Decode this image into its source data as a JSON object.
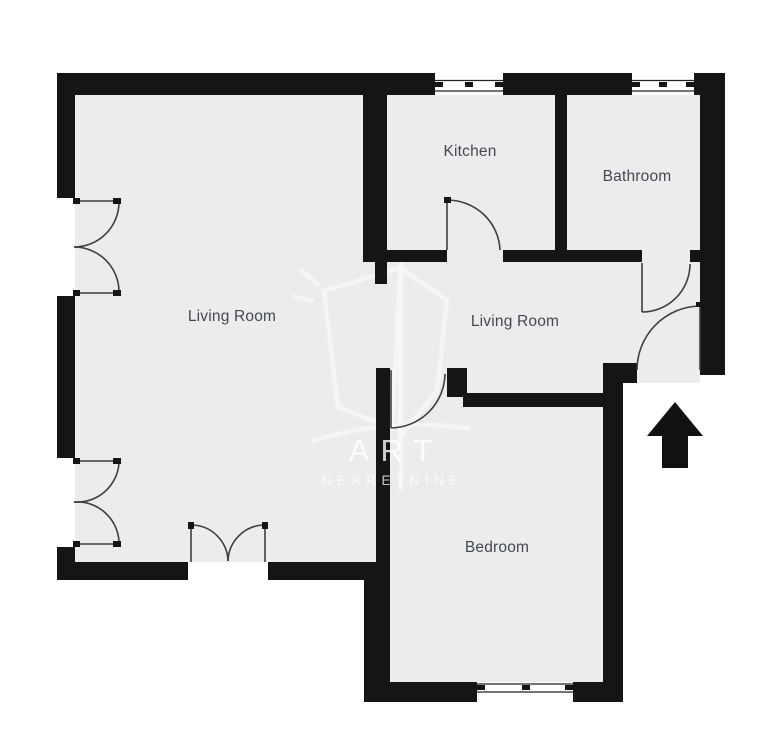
{
  "colors": {
    "wall": "#151515",
    "floor": "#ebeced",
    "outside": "#ffffff",
    "label": "#45484d",
    "door_arc": "#3f3f3f",
    "watermark": "#ffffff",
    "arrow": "#111111"
  },
  "rooms": [
    {
      "name": "kitchen",
      "label": "Kitchen"
    },
    {
      "name": "bathroom",
      "label": "Bathroom"
    },
    {
      "name": "living-room",
      "label": "Living Room"
    },
    {
      "name": "living-room-hall",
      "label": "Living Room"
    },
    {
      "name": "bedroom",
      "label": "Bedroom"
    }
  ],
  "watermark": {
    "line1": "ART",
    "line2": "NEKRETNINE"
  },
  "icons": [
    {
      "name": "entrance-arrow",
      "glyph": "up-arrow"
    }
  ]
}
